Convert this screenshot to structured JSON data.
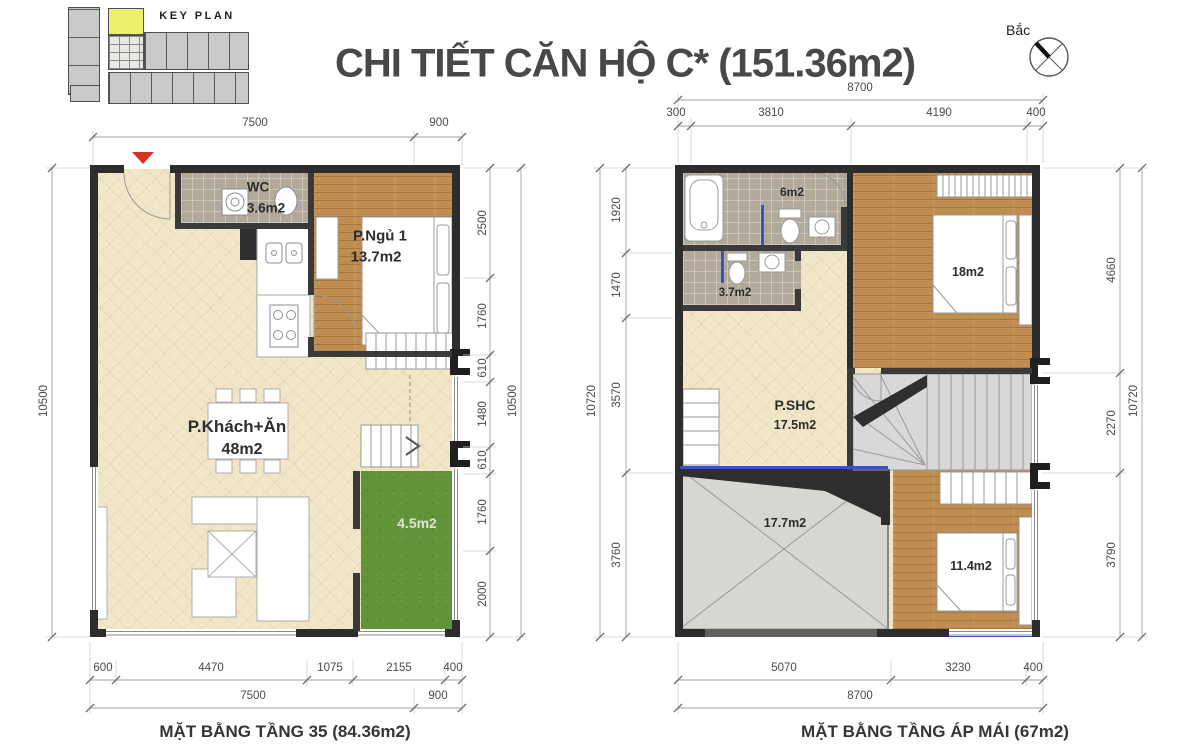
{
  "header": {
    "title": "CHI TIẾT CĂN HỘ C* (151.36m2)",
    "key_plan_label": "KEY PLAN",
    "north_label": "Bắc"
  },
  "colors": {
    "highlight_unit_yellow": "#ecef6c",
    "balcony_green": "#619339",
    "wood_floor": "#bf8d4f",
    "entry_marker_red": "#d93025",
    "roof_glass_blue": "#3853c4"
  },
  "plan_floor35": {
    "caption": "MẶT BẰNG TẦNG 35 (84.36m2)",
    "rooms": {
      "wc": {
        "name": "WC",
        "area": "3.6m2"
      },
      "bedroom_1": {
        "name": "P.Ngủ 1",
        "area": "13.7m2"
      },
      "living_dining": {
        "name": "P.Khách+Ăn",
        "area": "48m2"
      },
      "balcony": {
        "area": "4.5m2"
      }
    },
    "dims": {
      "top": [
        "7500",
        "900"
      ],
      "left_total": "10500",
      "right": [
        "2500",
        "1760",
        "610",
        "1480",
        "610",
        "1760",
        "2000"
      ],
      "right_total": "10500",
      "bottom": [
        "600",
        "4470",
        "1075",
        "2155",
        "400"
      ],
      "bottom2": [
        "7500",
        "900"
      ]
    }
  },
  "plan_attic": {
    "caption": "MẶT BẰNG TẦNG ÁP MÁI (67m2)",
    "rooms": {
      "bathroom": {
        "area": "6m2"
      },
      "wc": {
        "area": "3.7m2"
      },
      "bedroom_2": {
        "area": "18m2"
      },
      "family_room": {
        "name": "P.SHC",
        "area": "17.5m2"
      },
      "roof": {
        "area": "17.7m2"
      },
      "bedroom_3": {
        "area": "11.4m2"
      }
    },
    "dims": {
      "top_total": "8700",
      "top": [
        "300",
        "3810",
        "4190",
        "400"
      ],
      "left": [
        "1920",
        "1470",
        "3570",
        "3760"
      ],
      "left_total": "10720",
      "right": [
        "4660",
        "2270",
        "3790"
      ],
      "right_total": "10720",
      "bottom": [
        "5070",
        "3230",
        "400"
      ],
      "bottom_total": "8700"
    }
  }
}
